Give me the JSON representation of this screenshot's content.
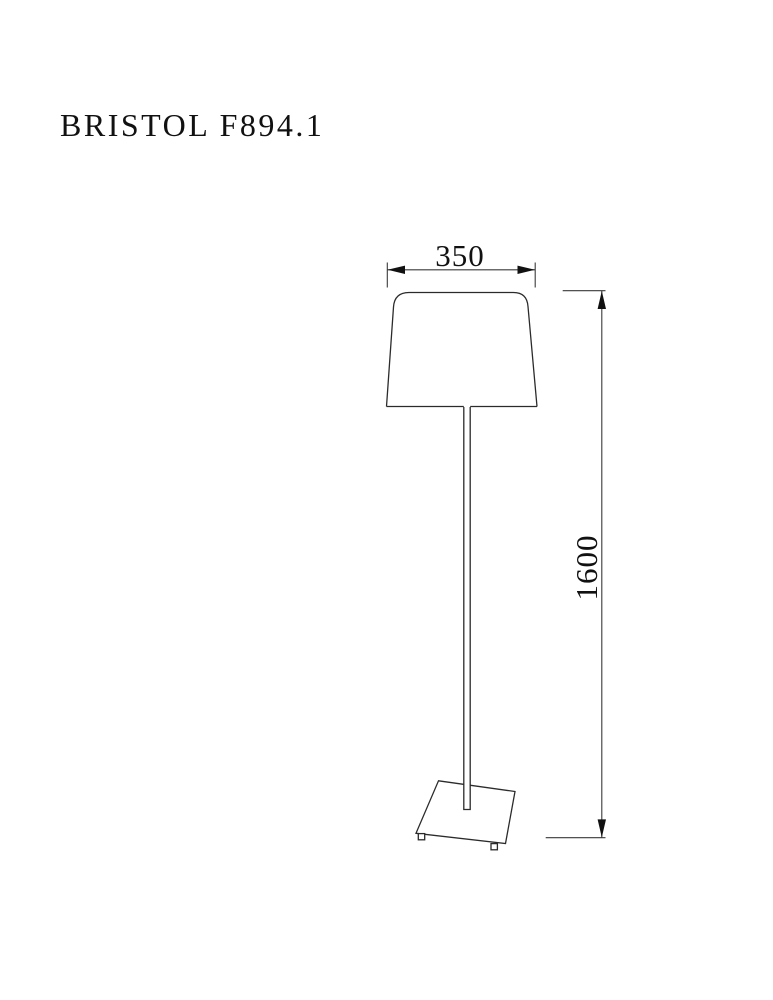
{
  "page": {
    "background": "#ffffff",
    "ink_color": "#2b2b2b",
    "text_color": "#111111"
  },
  "title": "BRISTOL F894.1",
  "drawing": {
    "subject": "floor-lamp-technical-drawing",
    "parts": [
      "lamp shade",
      "pole",
      "base with feet"
    ]
  },
  "dimensions": {
    "shade_width": "350",
    "overall_height": "1600"
  }
}
